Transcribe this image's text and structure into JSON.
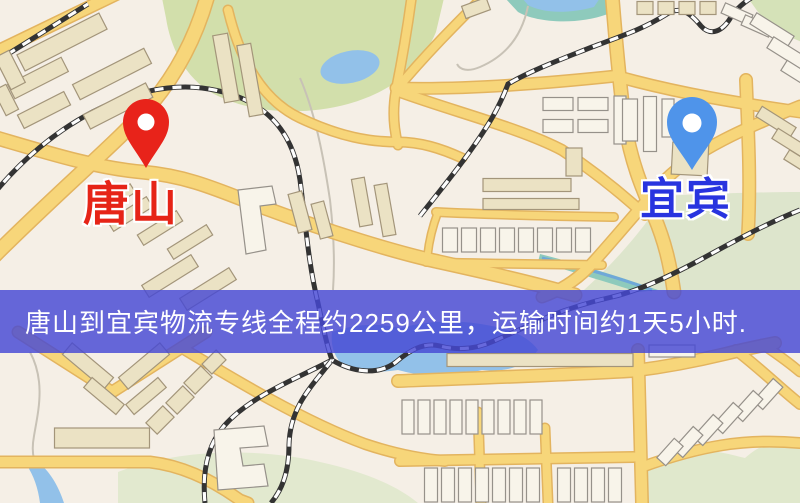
{
  "banner": {
    "text": "唐山到宜宾物流专线全程约2259公里，运输时间约1天5小时.",
    "background_color": "#4648d4",
    "text_color": "#ffffff"
  },
  "markers": {
    "origin": {
      "label": "唐山",
      "pin_color": "#e8231a",
      "label_color": "#e62417",
      "icon": "red-location-pin-icon"
    },
    "destination": {
      "label": "宜宾",
      "pin_color": "#4f94ea",
      "label_color": "#2834df",
      "icon": "blue-location-pin-icon"
    }
  },
  "map_palette": {
    "background": "#f5efe6",
    "road_fill": "#f7d67a",
    "road_edge": "#e3b45f",
    "park_green": "#d2dfab",
    "water_blue": "#92c1e9",
    "teal_water": "#8ecabc",
    "railway_black": "#333333",
    "building_tan": "#ebe2c4",
    "building_white": "#f8f4ea"
  }
}
